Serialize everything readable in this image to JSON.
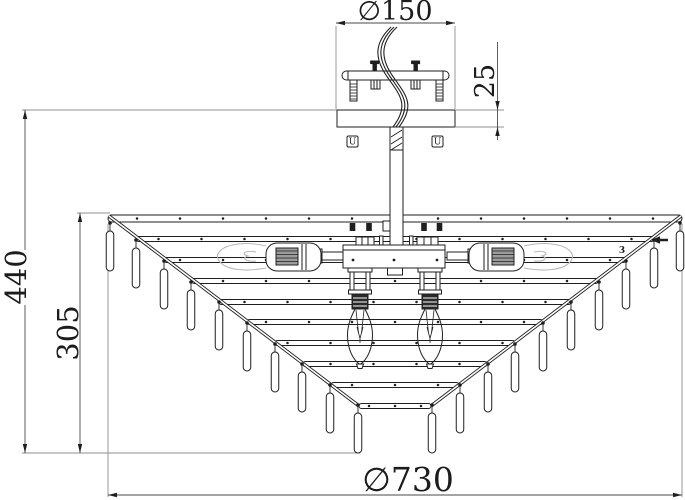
{
  "drawing": {
    "type": "technical-dimension-drawing",
    "subject": "ceiling chandelier side elevation"
  },
  "dimensions": {
    "canopy_diameter": "∅150",
    "canopy_height": "25",
    "total_height": "440",
    "frame_height": "305",
    "frame_diameter": "∅730"
  },
  "labels": {
    "mount_screw_left": "U",
    "mount_screw_right": "U",
    "part_marker": "3"
  },
  "colors": {
    "line": "#1f1f1f",
    "dim_line": "#4a4a4a",
    "ext_line": "#8f8f8f",
    "ghost": "#b9b9b9",
    "background": "#ffffff"
  },
  "structure": {
    "center_sum": 790,
    "rim": {
      "x": 108,
      "y": 215,
      "w": 574,
      "h": 7
    },
    "tier_h": 5,
    "tiers": [
      {
        "y": 239,
        "x1": 136
      },
      {
        "y": 260,
        "x1": 164
      },
      {
        "y": 281,
        "x1": 192
      },
      {
        "y": 302,
        "x1": 219
      },
      {
        "y": 322,
        "x1": 247
      },
      {
        "y": 343,
        "x1": 275
      },
      {
        "y": 364,
        "x1": 303
      },
      {
        "y": 385,
        "x1": 331
      },
      {
        "y": 406,
        "x1": 359
      }
    ],
    "diagonal": {
      "x1": 109,
      "y1": 216,
      "x2": 359,
      "y2": 406
    },
    "pendant_hooks_left": [
      [
        110,
        221
      ],
      [
        136,
        238
      ],
      [
        164,
        259
      ],
      [
        191,
        280
      ],
      [
        219,
        300
      ],
      [
        247,
        321
      ],
      [
        275,
        342
      ],
      [
        302,
        362
      ],
      [
        330,
        383
      ],
      [
        358,
        403
      ]
    ],
    "pendant": {
      "drop": 8,
      "len": 40,
      "w": 7.5
    },
    "dot_spacing": 43,
    "dot_spacing_small": 26
  }
}
